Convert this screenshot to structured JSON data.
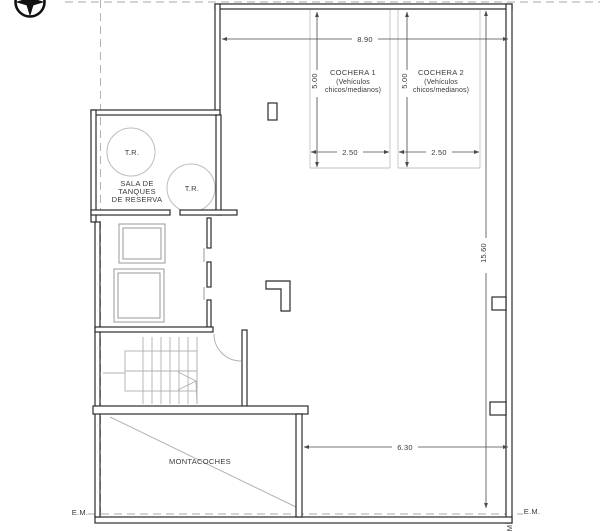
{
  "plan": {
    "rooms": {
      "tank_room": {
        "line1": "SALA DE",
        "line2": "TANQUES",
        "line3": "DE RESERVA",
        "tank_label": "T.R."
      },
      "cochera1": {
        "title": "COCHERA 1",
        "subtitle1": "(Vehículos",
        "subtitle2": "chicos/medianos)"
      },
      "cochera2": {
        "title": "COCHERA 2",
        "subtitle1": "(Vehículos",
        "subtitle2": "chicos/medianos)"
      },
      "car_lift": {
        "label": "MONTACOCHES"
      }
    },
    "dimensions": {
      "top_width": "8.90",
      "bay_depth": "5.00",
      "bay1_width": "2.50",
      "bay2_width": "2.50",
      "right_height": "15.60",
      "bottom_width": "6.30"
    },
    "markers": {
      "em_left": "E.M.",
      "em_right": "E.M.",
      "em_rotated": "M"
    }
  }
}
